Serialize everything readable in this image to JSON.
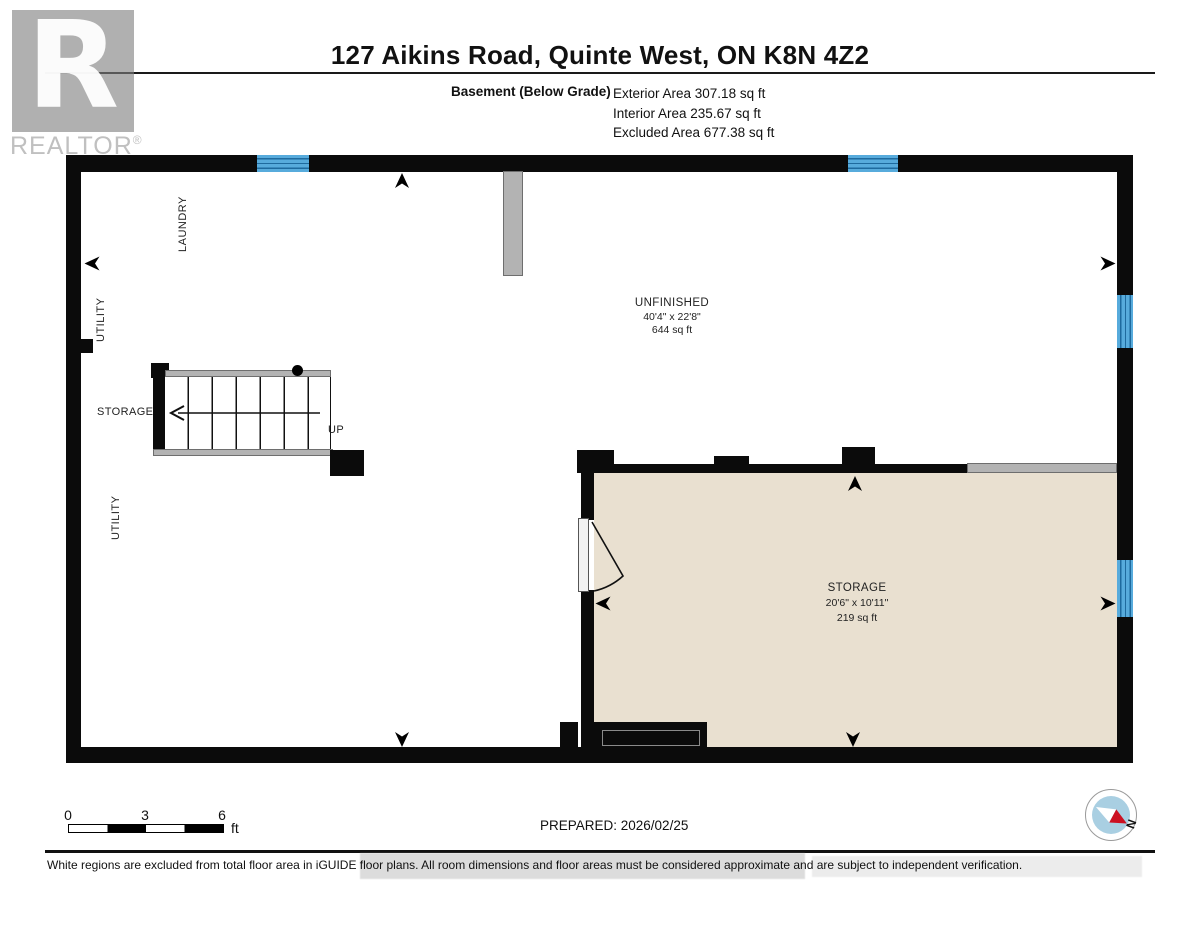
{
  "header": {
    "title": "127 Aikins Road, Quinte West, ON K8N 4Z2",
    "floor_label": "Basement (Below Grade)",
    "areas": [
      "Exterior Area 307.18 sq ft",
      "Interior Area 235.67 sq ft",
      "Excluded Area 677.38 sq ft"
    ],
    "logo": {
      "letter": "R",
      "word": "REALTOR",
      "reg": "®"
    }
  },
  "plan": {
    "labels": {
      "laundry": "LAUNDRY",
      "utility": "UTILITY",
      "storage_side": "STORAGE",
      "up": "UP"
    },
    "rooms": {
      "unfinished": {
        "name": "UNFINISHED",
        "dims": "40'4\" x 22'8\"",
        "area": "644 sq ft"
      },
      "storage": {
        "name": "STORAGE",
        "dims": "20'6\" x 10'11\"",
        "area": "219 sq ft"
      }
    },
    "colors": {
      "wall": "#0b0b0b",
      "window_blue": "#57abdc",
      "excluded_floor_white": "#ffffff",
      "storage_floor_beige": "#e9e0d0",
      "gray_feature": "#b3b3b3"
    }
  },
  "footer": {
    "scale": {
      "ticks": [
        "0",
        "3",
        "6"
      ],
      "unit": "ft"
    },
    "prepared": "PREPARED: 2026/02/25",
    "compass": {
      "north": "N"
    },
    "disclaimer": "White regions are excluded from total floor area in iGUIDE floor plans. All room dimensions and floor areas must be considered approximate and are subject to independent verification."
  }
}
